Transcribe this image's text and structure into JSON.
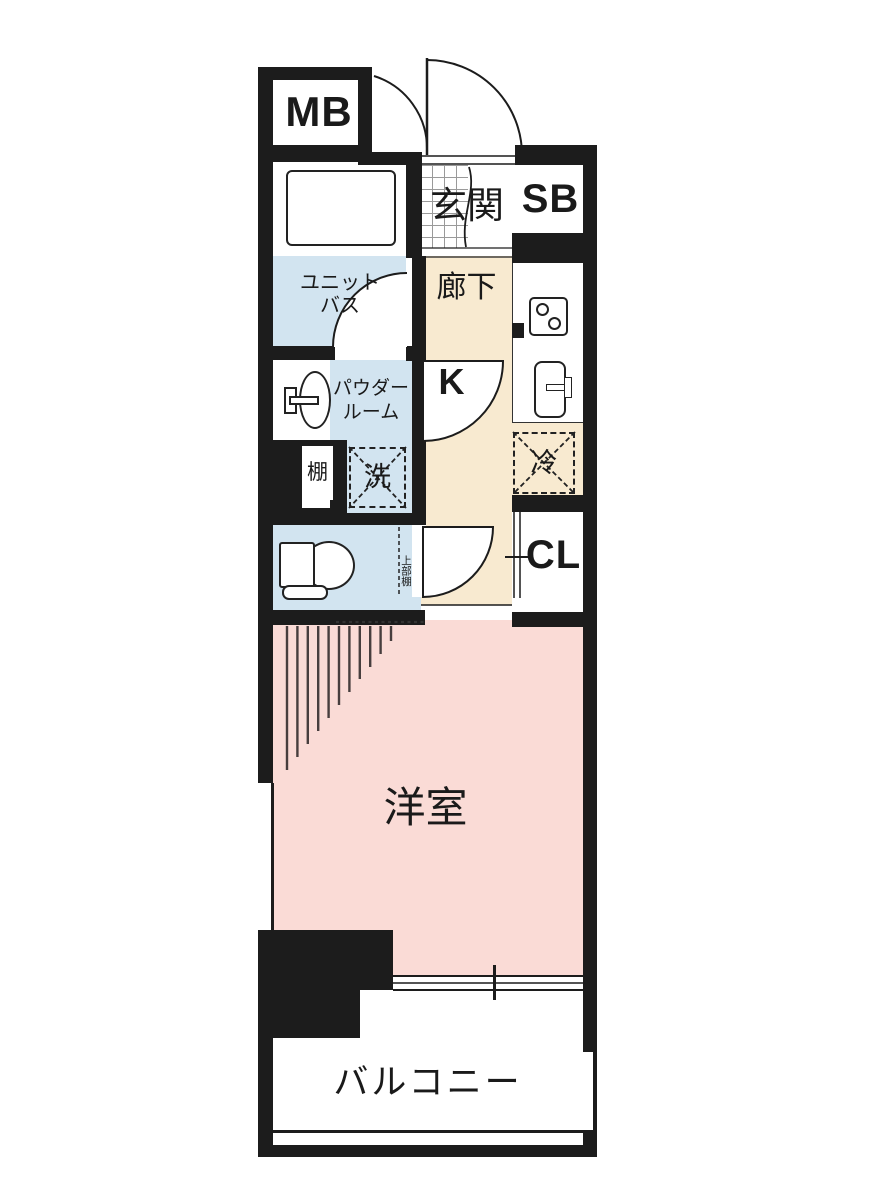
{
  "floorplan": {
    "type": "japanese-apartment-floor-plan",
    "labels": {
      "meter_box": "MB",
      "entrance": "玄関",
      "shoe_box": "SB",
      "unit_bath_line1": "ユニット",
      "unit_bath_line2": "バス",
      "corridor": "廊下",
      "kitchen": "K",
      "powder_room_line1": "パウダー",
      "powder_room_line2": "ルーム",
      "shelf": "棚",
      "washer": "洗",
      "fridge": "冷",
      "closet": "CL",
      "upper_shelf": "上部棚",
      "western_room": "洋室",
      "balcony": "バルコニー"
    },
    "colors": {
      "wall": "#1c1c1c",
      "wet_area_blue": "#d2e4f0",
      "corridor_cream": "#f8ead0",
      "room_pink": "#fadbd6",
      "background": "#ffffff"
    }
  }
}
